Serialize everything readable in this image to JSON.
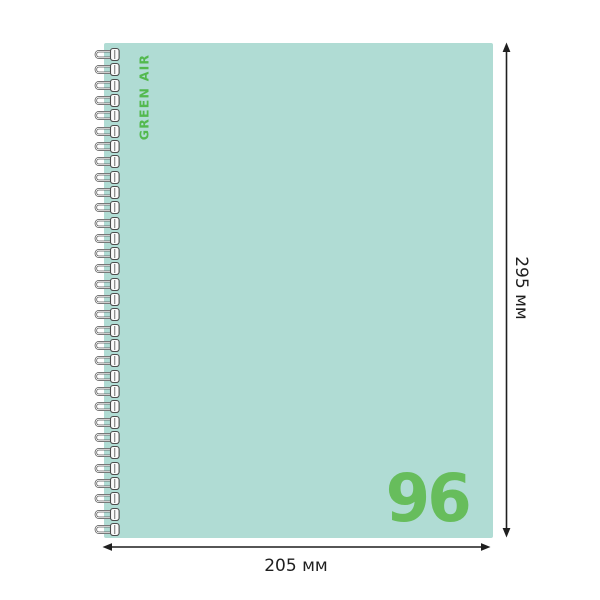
{
  "product": {
    "brand_label": "GREEN AIR",
    "sheet_count": "96"
  },
  "dimensions": {
    "height_label": "295 мм",
    "width_label": "205 мм"
  },
  "binding": {
    "type": "wire-spiral",
    "loop_count": 32,
    "loop_spacing_px": 15.32
  },
  "colors": {
    "cover": "#b0dcd4",
    "brand_green": "#53b94e",
    "number_green": "#67bd5c",
    "dimension_dark": "#1f1f1f",
    "wire_outline": "#4d4d4d",
    "wire_fill": "#fafafa",
    "background": "#ffffff"
  }
}
